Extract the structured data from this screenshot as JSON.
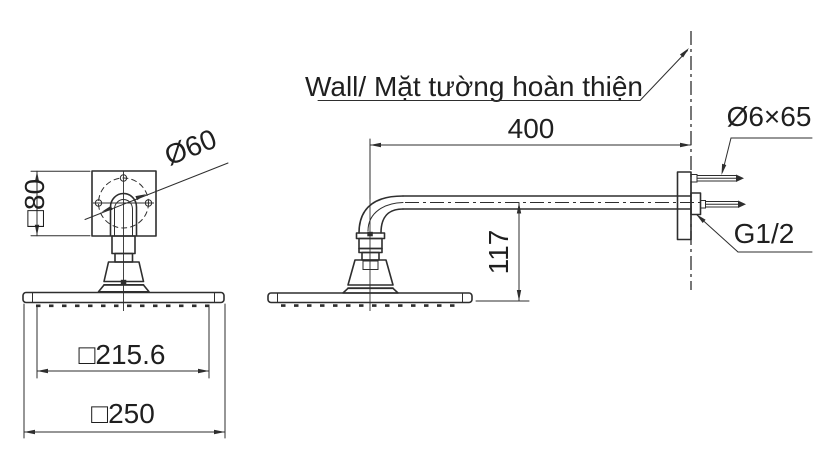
{
  "colors": {
    "line": "#2e2e2e",
    "text": "#1f1f1f",
    "background": "#ffffff"
  },
  "drawing": {
    "title_note": "Wall/ Mặt tường hoàn thiện",
    "front_view": {
      "plate_size": "□80",
      "pitch_circle_diameter": "Ø60",
      "spray_face_width": "□215.6",
      "head_width": "□250"
    },
    "side_view": {
      "arm_length": "400",
      "head_drop": "117",
      "screw_spec": "Ø6×65",
      "thread_spec": "G1/2"
    }
  }
}
